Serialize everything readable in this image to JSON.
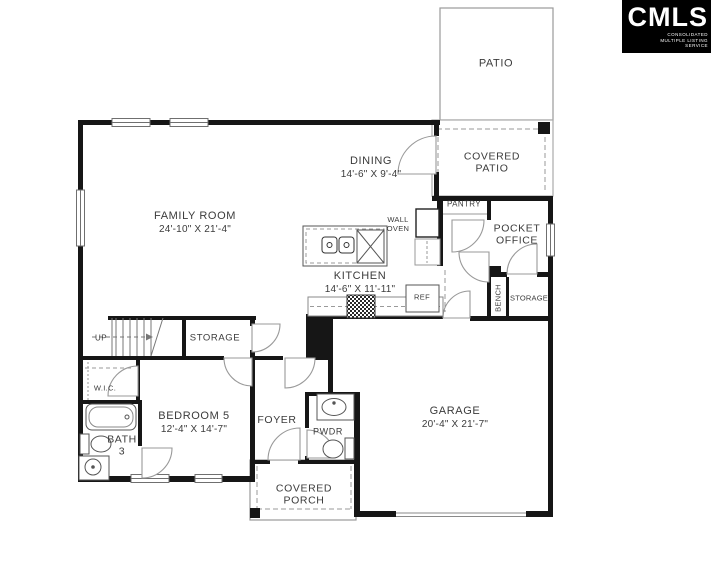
{
  "logo": {
    "brand": "CMLS",
    "tagline": "CONSOLIDATED MULTIPLE LISTING SERVICE"
  },
  "rooms": {
    "patio": {
      "label": "PATIO"
    },
    "covered_patio": {
      "label": "COVERED PATIO"
    },
    "dining": {
      "label": "DINING",
      "dims": "14'-6\" X 9'-4\""
    },
    "family_room": {
      "label": "FAMILY ROOM",
      "dims": "24'-10\" X 21'-4\""
    },
    "kitchen": {
      "label": "KITCHEN",
      "dims": "14'-6\" X 11'-11\""
    },
    "pantry": {
      "label": "PANTRY"
    },
    "pocket_office": {
      "label": "POCKET OFFICE"
    },
    "bench": {
      "label": "BENCH"
    },
    "storage_right": {
      "label": "STORAGE"
    },
    "storage_left": {
      "label": "STORAGE"
    },
    "stairs": {
      "label": "UP"
    },
    "wic": {
      "label": "W.I.C."
    },
    "bath": {
      "label": "BATH",
      "number": "3"
    },
    "bedroom5": {
      "label": "BEDROOM 5",
      "dims": "12'-4\" X 14'-7\""
    },
    "foyer": {
      "label": "FOYER"
    },
    "pwdr": {
      "label": "PWDR"
    },
    "garage": {
      "label": "GARAGE",
      "dims": "20'-4\" X 21'-7\""
    },
    "covered_porch": {
      "label": "COVERED PORCH"
    },
    "appliances": {
      "wall_oven": "WALL OVEN",
      "ref": "REF"
    }
  },
  "colors": {
    "wall": "#161616",
    "thin_line": "#8a8a8a",
    "text": "#3b3b3b",
    "logo_bg": "#000000",
    "logo_text": "#ffffff"
  }
}
